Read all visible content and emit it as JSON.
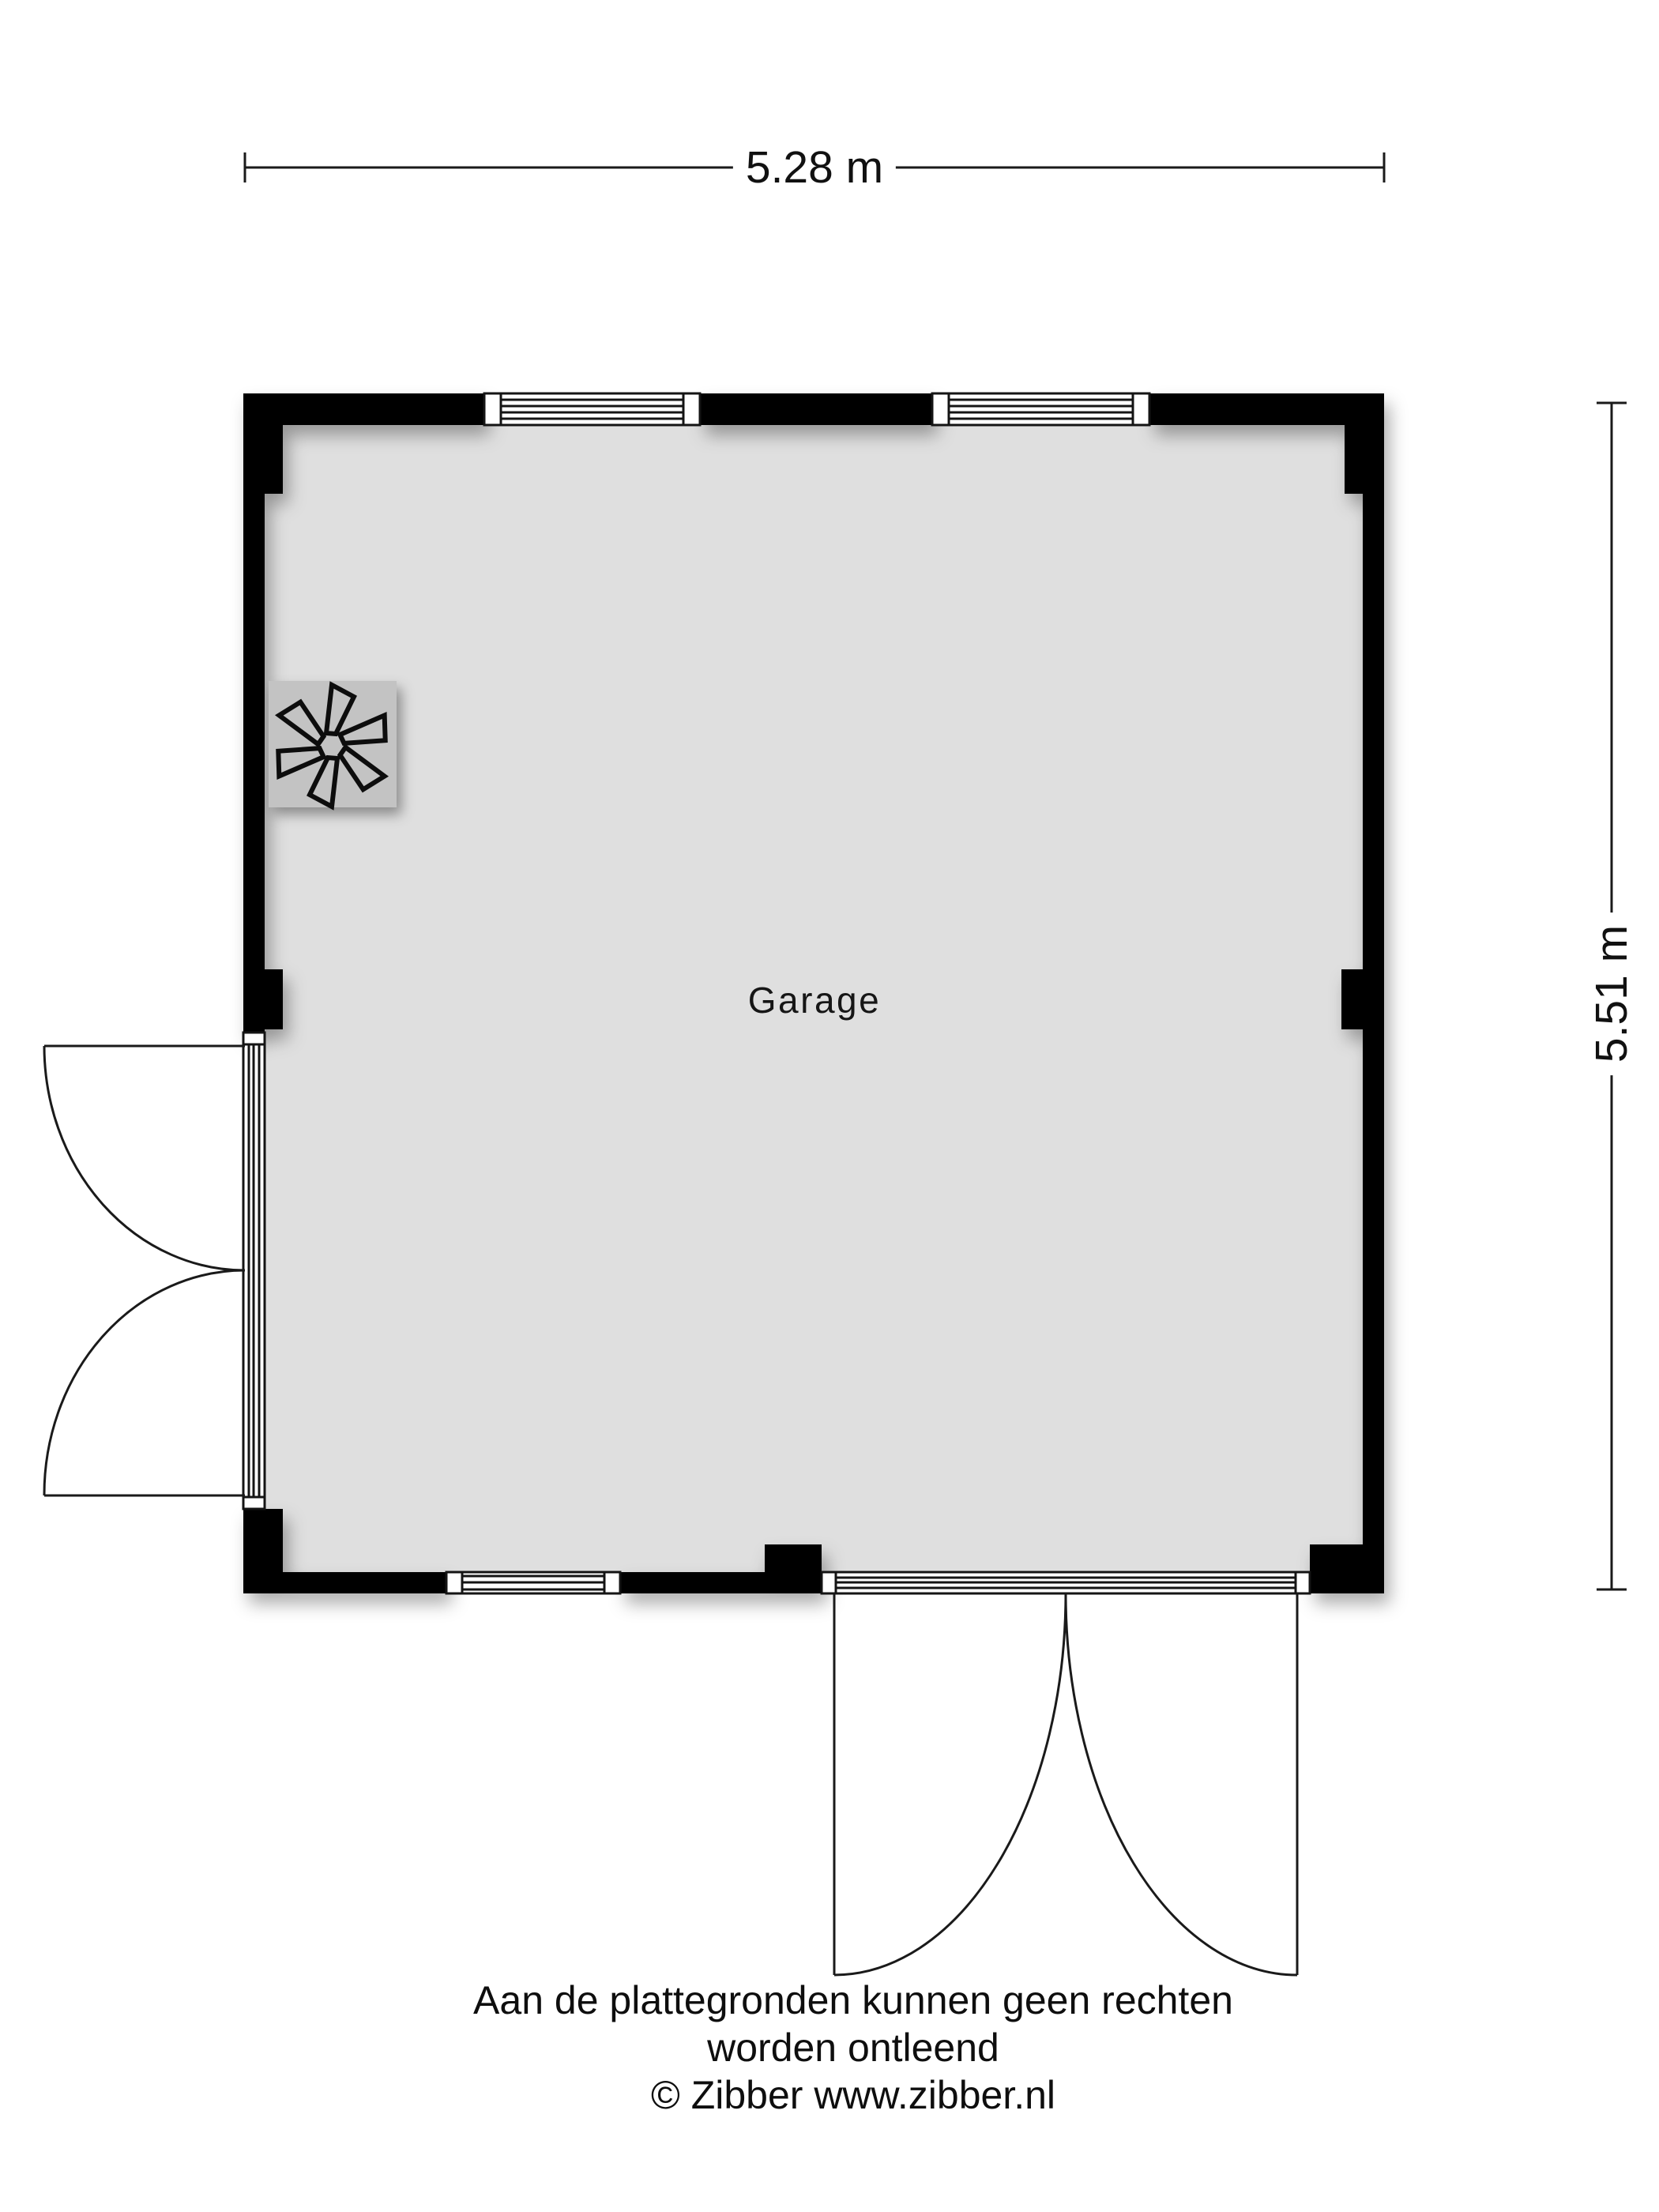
{
  "floorplan": {
    "room": {
      "label": "Garage"
    },
    "dimensions": {
      "width_label": "5.28 m",
      "height_label": "5.51 m"
    },
    "fixtures": {
      "fan_unit": "mechanical-ventilation-fan"
    },
    "footer": {
      "line1": "Aan de plattegronden kunnen geen rechten worden ontleend",
      "line2": "© Zibber www.zibber.nl"
    },
    "colors": {
      "background": "#ffffff",
      "wall": "#020202",
      "floor": "#dfdfdf",
      "fan_unit": "#c3c3c3",
      "line": "#1a1a1a"
    }
  }
}
